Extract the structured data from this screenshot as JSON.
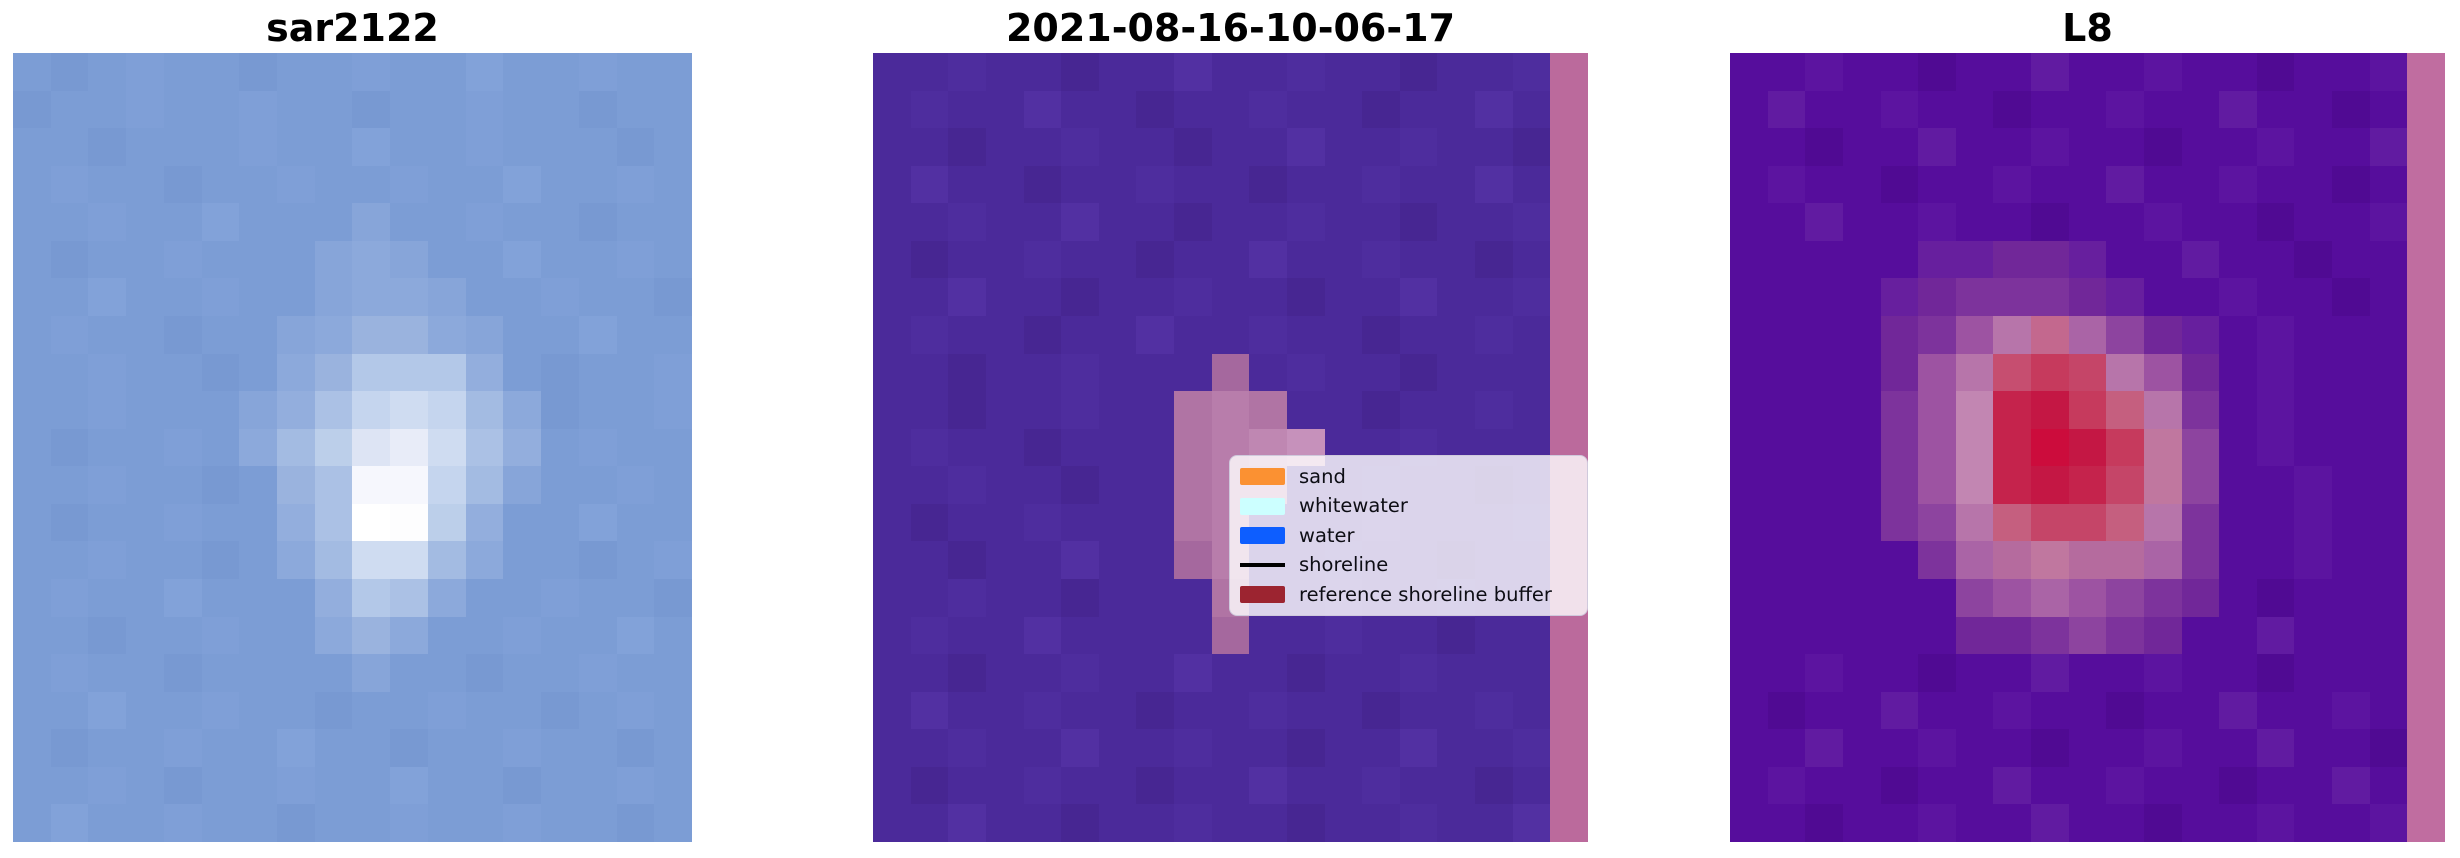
{
  "figure": {
    "background": "#ffffff",
    "title_color": "#000000"
  },
  "chart_data": [
    {
      "type": "heatmap",
      "title": "sar2122",
      "content": "pixelated SAR backscatter image, blue background with bright white blob left of center",
      "grid": {
        "cols": 18,
        "palette": {
          ".": "#7c9dd5",
          ",": "#7899d2",
          "-": "#7f9fd7",
          ";": "#82a2d9",
          "a": "#87a5d9",
          "b": "#8ca9db",
          "c": "#93aedd",
          "d": "#9ab3de",
          "e": "#a3bbe2",
          "f": "#abc1e5",
          "g": "#b3c8e8",
          "h": "#bccfea",
          "i": "#c5d5ee",
          "j": "#cfdcf1",
          "k": "#dde4f4",
          "l": "#e8ecf8",
          "m": "#f6f7fd",
          "n": "#fdfdfe",
          "o": "#ffffff"
        },
        "rows": [
          ".,.-..,..-..;..-..",
          ",..-..-..,..-..,..",
          "..,...-..;..-...,.",
          ".-..,..-..-..;..-.",
          "..-..;...a..-..,..",
          ".,..-...aba..;..-.",
          "..;..-..abba..-..,",
          ".-..,..abddba..;..",
          "..-..,.bdgggc.,..-",
          "..-...acfijieb,..-",
          ".,..-.behkljfc.-..",
          "..-..,.dfmmiea..-.",
          ".,..-..cfonhc..;..",
          "..-..,.bejjeb..,.-",
          ".-..;...cgfb..-..,",
          "..,..-..bdb..-..;.",
          ".-..,....a..,..-..",
          "..;..-..,..-..,.-.",
          ".,..-..;..,..-..,.",
          "..-.,..-..;..,..-.",
          ".;..-..,..-..-..,."
        ]
      }
    },
    {
      "type": "heatmap",
      "title": "2021-08-16-10-06-17",
      "content": "classified satellite image, purple background, pink detected patch, pink reference shoreline buffer stripe on right edge",
      "grid": {
        "cols": 19,
        "palette": {
          ".": "#4b2a9a",
          ",": "#4e2d9e",
          "-": "#472692",
          ";": "#5230a2",
          "p": "#a5689e",
          "q": "#b074a4",
          "r": "#b87dab",
          "s": "#bf87b2",
          "t": "#c691bb",
          "S": "#bb6a9c"
        },
        "rows": [
          "..,..-..;..,..-..,S",
          ".,..;..-..,..-..;.S",
          "..-..,..-..;..,..-S",
          ".;..-..,..-..,..;.S",
          "..,..;..-..,..-..,S",
          ".-..,..-..;..,..-.S",
          "..;..-..,..-..;..,S",
          ".,..-..;..,..-..,.S",
          "..-..,...p.,..-...S",
          "..-..,..qrq..-..,.S",
          ".,..-...qrst..,...S",
          "..,..-..qrr..,..-.S",
          ".-..,...qr...;...,S",
          "..-..;..pr..,..-..S",
          "..,..-...q..;..,..S",
          ".,..;....p..,..-..S",
          "..-..,..;..-..,...S",
          ".;..,..-..,..-..,.S",
          "..,..;..,..-..;..,S",
          ".-..,..-..;..,..-.S",
          "..;..-..,..-..,..;S"
        ]
      },
      "legend": {
        "entries": [
          {
            "label": "sand",
            "swatch": "patch",
            "color": "#fb9132"
          },
          {
            "label": "whitewater",
            "swatch": "patch",
            "color": "#ccffff"
          },
          {
            "label": "water",
            "swatch": "patch",
            "color": "#0d5eff"
          },
          {
            "label": "shoreline",
            "swatch": "line",
            "color": "#000000"
          },
          {
            "label": "reference shoreline buffer",
            "swatch": "patch",
            "color": "#9c2430"
          }
        ]
      }
    },
    {
      "type": "heatmap",
      "title": "L8",
      "content": "Landsat 8 index image, purple background, crimson-core pink blob, pink reference buffer stripe on right edge",
      "grid": {
        "cols": 19,
        "palette": {
          ".": "#560d9c",
          ",": "#5c14a0",
          "-": "#500a93",
          ";": "#611ba1",
          "A": "#671f9e",
          "B": "#712799",
          "C": "#7d339c",
          "D": "#8d449f",
          "E": "#9d53a2",
          "F": "#aa64a6",
          "G": "#b775aa",
          "H": "#c286b2",
          "J": "#c3688e",
          "K": "#c64e70",
          "L": "#c63a5d",
          "M": "#c5234c",
          "N": "#cc0c3c",
          "O": "#c41744",
          "P": "#c54568",
          "Q": "#c55f7f",
          "R": "#c0779f",
          "T": "#b56b9e",
          "S": "#c06da0"
        },
        "rows": [
          "..,..-..;..,..-..,S",
          ".;..,..-..,..;..-.S",
          "..-..;..,..-..,..;S",
          ".,..-..,..;..,..-.S",
          "..;..,..-..,..-..,S",
          ".....AABBA..;..-..S",
          "....ABCCCBA..,..-.S",
          "....BCEGJFDBA.,...S",
          "....BEGKLPGEB.,...S",
          "....CEHMOLQGC.,...S",
          "....CEHMNOLRD.,...S",
          "....CEHMOMPRD..,..S",
          "....CDGQPPQGC..,..S",
          ".....CFTRTTFC..,..S",
          "......DEFEDCB.-...S",
          "......BBCDCB..;...S",
          "..,..-..;..,..-...S",
          ".-..;..,..-..;..,.S",
          "..;..,..-..,..;..-S",
          ".,..-..;..,..-..;.S",
          "..-..,..;..-..,..,S"
        ]
      }
    }
  ]
}
